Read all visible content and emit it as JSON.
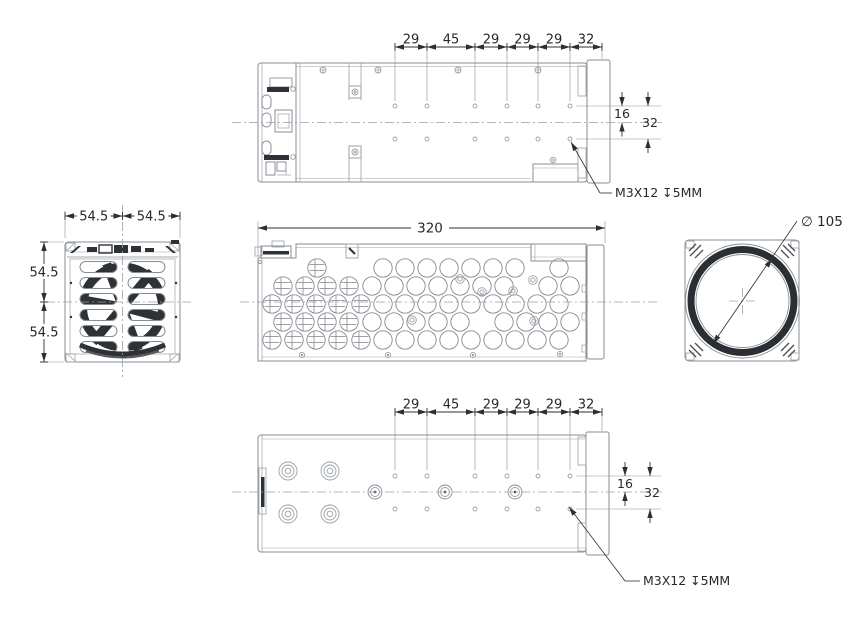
{
  "drawing": {
    "dimensions": {
      "chain": [
        "29",
        "45",
        "29",
        "29",
        "29",
        "32"
      ],
      "d16": "16",
      "d32": "32",
      "overall_length": "320",
      "half_width": "54.5",
      "lens_diameter": "∅ 105",
      "mount_note": "M3X12 ↧5MM"
    },
    "colors": {
      "body_line": "#878d94",
      "light_line": "#9aa0a6",
      "dark_fill": "#2e3135",
      "dimension": "#2c2f33",
      "text": "#26282c",
      "background": "#ffffff"
    }
  }
}
